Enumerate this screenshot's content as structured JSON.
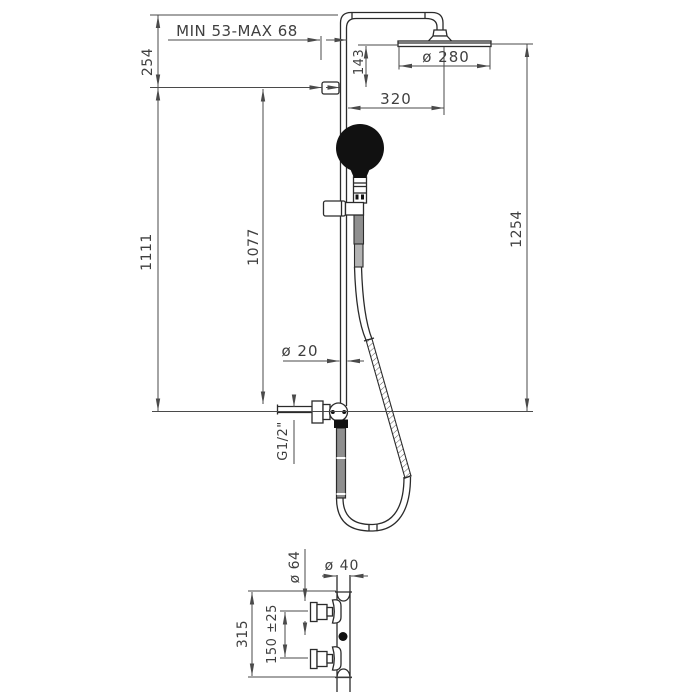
{
  "figure": {
    "type": "technical-drawing",
    "subject": "shower column with overhead shower, hand shower and thermostatic mixer - installation dimensions",
    "colors": {
      "background": "#ffffff",
      "outline": "#2b2b2b",
      "dimension_lines": "#4a4a4a",
      "text": "#3f3f3f",
      "hose_fill": "#8f8f8f",
      "handshower_fill": "#111111"
    },
    "main": {
      "labels": {
        "adjustment": "MIN 53-MAX 68",
        "top_offset": "254",
        "head_drop": "143",
        "head_diameter": "ø 280",
        "arm_reach": "320",
        "total_height": "1254",
        "rail_height": "1111",
        "hose_connection_height": "1077",
        "rail_diameter": "ø 20",
        "thread": "G1/2\""
      }
    },
    "detail": {
      "labels": {
        "escutcheon_diameter": "ø 64",
        "body_diameter": "ø 40",
        "detail_height": "315",
        "inlet_spacing": "150 ±25"
      }
    }
  }
}
